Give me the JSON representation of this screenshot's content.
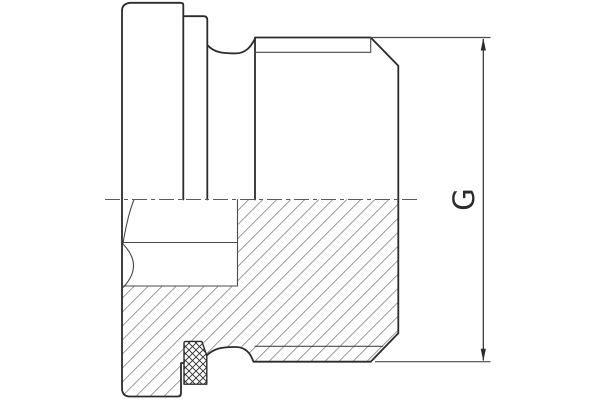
{
  "drawing": {
    "kind": "screw-plug-section-drawing",
    "dimension": {
      "label": "G"
    },
    "colors": {
      "background": "#ffffff",
      "line": "#2b2b2b",
      "thin_line": "#4a4a4a",
      "hatch": "#3a3a3a",
      "centerline": "#5a5a5a"
    }
  }
}
